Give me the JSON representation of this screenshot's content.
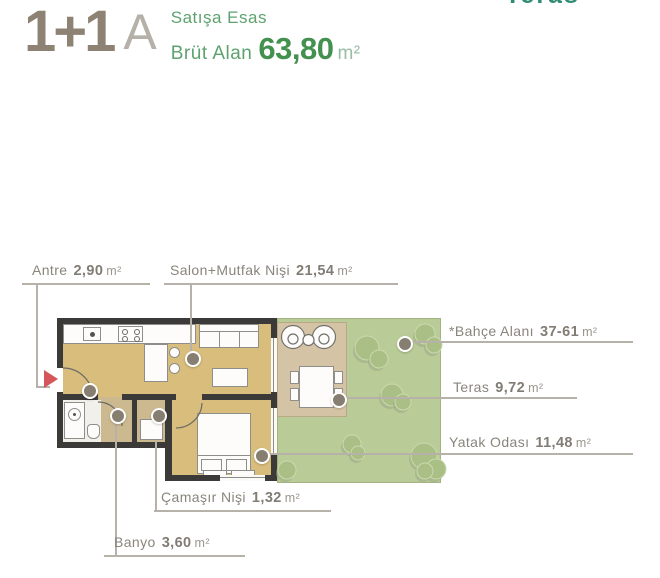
{
  "header": {
    "plan_type": "1+1",
    "variant": "A",
    "subtitle1": "Satışa Esas",
    "subtitle2": "Brüt Alan",
    "area_value": "63,80",
    "area_unit": "m²",
    "clipped_text": "Teras"
  },
  "rooms": [
    {
      "label": "Antre",
      "value": "2,90",
      "unit": "m²"
    },
    {
      "label": "Salon+Mutfak Nişi",
      "value": "21,54",
      "unit": "m²"
    },
    {
      "label": "*Bahçe Alanı",
      "value": "37-61",
      "unit": "m²"
    },
    {
      "label": "Teras",
      "value": "9,72",
      "unit": "m²"
    },
    {
      "label": "Yatak Odası",
      "value": "11,48",
      "unit": "m²"
    },
    {
      "label": "Çamaşır Nişi",
      "value": "1,32",
      "unit": "m²"
    },
    {
      "label": "Banyo",
      "value": "3,60",
      "unit": "m²"
    }
  ],
  "colors": {
    "logo_brown": "#8e8274",
    "logo_letter_gray": "#b5b0a8",
    "text_green": "#5da26e",
    "area_green": "#43904f",
    "clipped_teal": "#2f8b74",
    "label_gray": "#8a857c",
    "leader_gray": "#b6b1a9",
    "wall_dark": "#3b3a38",
    "floor_tan": "#d8bd7c",
    "corridor_tan": "#cdb98f",
    "terrace_tan": "#d5c3a5",
    "garden_green": "#b9cb96",
    "tree_green": "#a9bf85",
    "marker_gray": "#867e70",
    "arrow_red": "#d4565a"
  }
}
